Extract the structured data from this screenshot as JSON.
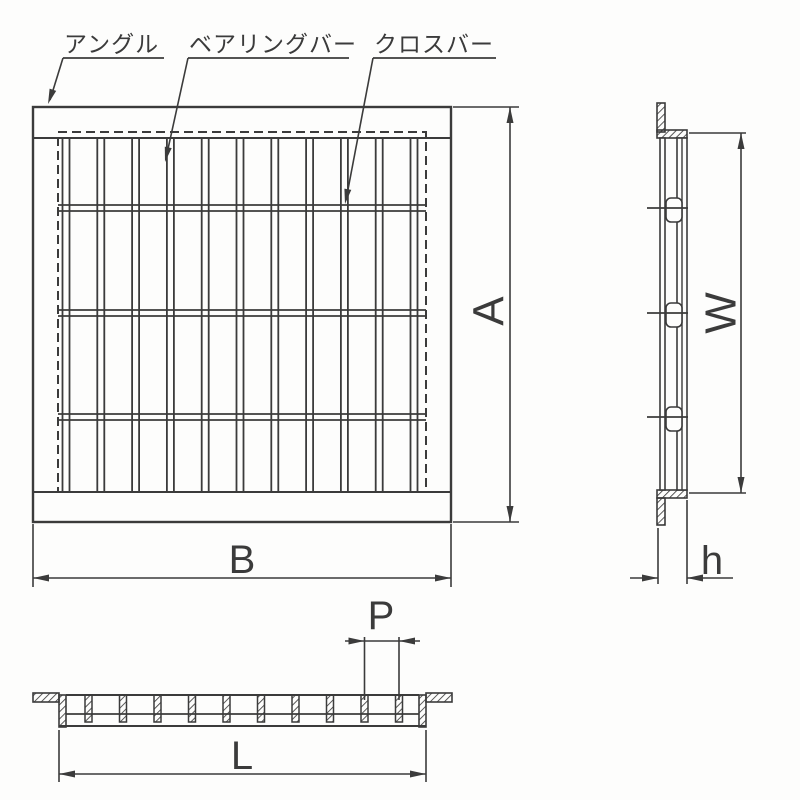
{
  "drawing": {
    "type": "technical-drawing",
    "subject": "steel grating dimension diagram",
    "labels": {
      "angle": "アングル",
      "bearing_bar": "ベアリングバー",
      "cross_bar": "クロスバー"
    },
    "dims": {
      "A": "A",
      "B": "B",
      "W": "W",
      "h": "h",
      "P": "P",
      "L": "L"
    },
    "colors": {
      "line": "#3b3b3b",
      "h_letter": "#2b4a8c",
      "background": "#fdfdfc"
    }
  }
}
